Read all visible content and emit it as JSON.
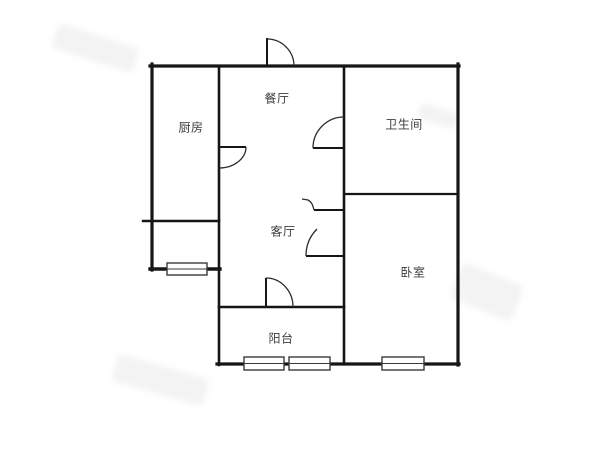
{
  "plan": {
    "type": "apartment-floor-plan",
    "background": "#ffffff",
    "wall_color": "#161616",
    "arc_color": "#2b2b2b",
    "label_color": "#3c3c3c"
  },
  "rooms": [
    {
      "id": "kitchen",
      "label": "厨房",
      "cx": 191,
      "cy": 127
    },
    {
      "id": "dining",
      "label": "餐厅",
      "cx": 277,
      "cy": 98
    },
    {
      "id": "bathroom",
      "label": "卫生间",
      "cx": 404,
      "cy": 124
    },
    {
      "id": "living",
      "label": "客厅",
      "cx": 283,
      "cy": 231
    },
    {
      "id": "bedroom",
      "label": "卧室",
      "cx": 413,
      "cy": 272
    },
    {
      "id": "balcony",
      "label": "阳台",
      "cx": 281,
      "cy": 338
    }
  ],
  "floorplan": {
    "walls": [
      {
        "x1": 150,
        "y1": 66,
        "x2": 459,
        "y2": 66,
        "w": 3.2
      },
      {
        "x1": 458,
        "y1": 64,
        "x2": 458,
        "y2": 365,
        "w": 3.2
      },
      {
        "x1": 217,
        "y1": 364,
        "x2": 459,
        "y2": 364,
        "w": 3.2
      },
      {
        "x1": 152,
        "y1": 64,
        "x2": 152,
        "y2": 270,
        "w": 3.2
      },
      {
        "x1": 150,
        "y1": 269,
        "x2": 220,
        "y2": 269,
        "w": 3.4
      },
      {
        "x1": 219,
        "y1": 66,
        "x2": 219,
        "y2": 365,
        "w": 2.6
      },
      {
        "x1": 344,
        "y1": 66,
        "x2": 344,
        "y2": 364,
        "w": 2.6
      },
      {
        "x1": 344,
        "y1": 194,
        "x2": 458,
        "y2": 194,
        "w": 2.2
      },
      {
        "x1": 219,
        "y1": 307,
        "x2": 344,
        "y2": 307,
        "w": 2.6
      },
      {
        "x1": 143,
        "y1": 221,
        "x2": 219,
        "y2": 221,
        "w": 2.4
      }
    ],
    "doors": [
      {
        "name": "entry-door",
        "leaf": [
          267,
          38,
          267,
          66
        ],
        "arc": "M267,39 A27,27 0 0 1 294,66"
      },
      {
        "name": "kitchen-door",
        "leaf": [
          219,
          147,
          246,
          147
        ],
        "arc": "M246,147 A27,21 0 0 1 219,168"
      },
      {
        "name": "bathroom-door",
        "leaf": [
          313,
          148,
          344,
          148
        ],
        "arc": "M313,148 A31,31 0 0 1 344,117"
      },
      {
        "name": "hall-small-door",
        "leaf": [
          314,
          210,
          344,
          210
        ],
        "arc": "M314,210 C313,206 312,202 308,200 L302,199"
      },
      {
        "name": "bedroom-door",
        "leaf": [
          306,
          256,
          344,
          256
        ],
        "arc": "M306,256 A38,38 0 0 1 317,229"
      },
      {
        "name": "balcony-door",
        "leaf": [
          266,
          278,
          266,
          307
        ],
        "arc": "M266,278 A27,29 0 0 1 293,307"
      }
    ],
    "windows": [
      {
        "name": "kitchen-annex-window",
        "x": 167,
        "y": 263,
        "w": 40,
        "h": 12
      },
      {
        "name": "balcony-window-left",
        "x": 244,
        "y": 357,
        "w": 40,
        "h": 13
      },
      {
        "name": "balcony-window-right",
        "x": 289,
        "y": 357,
        "w": 41,
        "h": 13
      },
      {
        "name": "bedroom-window",
        "x": 382,
        "y": 357,
        "w": 42,
        "h": 13
      }
    ],
    "watermarks": [
      {
        "x": 95,
        "y": 48,
        "w": 85,
        "h": 26,
        "r": 18
      },
      {
        "x": 487,
        "y": 292,
        "w": 66,
        "h": 38,
        "r": 22
      },
      {
        "x": 160,
        "y": 380,
        "w": 95,
        "h": 28,
        "r": 16
      },
      {
        "x": 438,
        "y": 116,
        "w": 40,
        "h": 16,
        "r": 18
      }
    ]
  }
}
